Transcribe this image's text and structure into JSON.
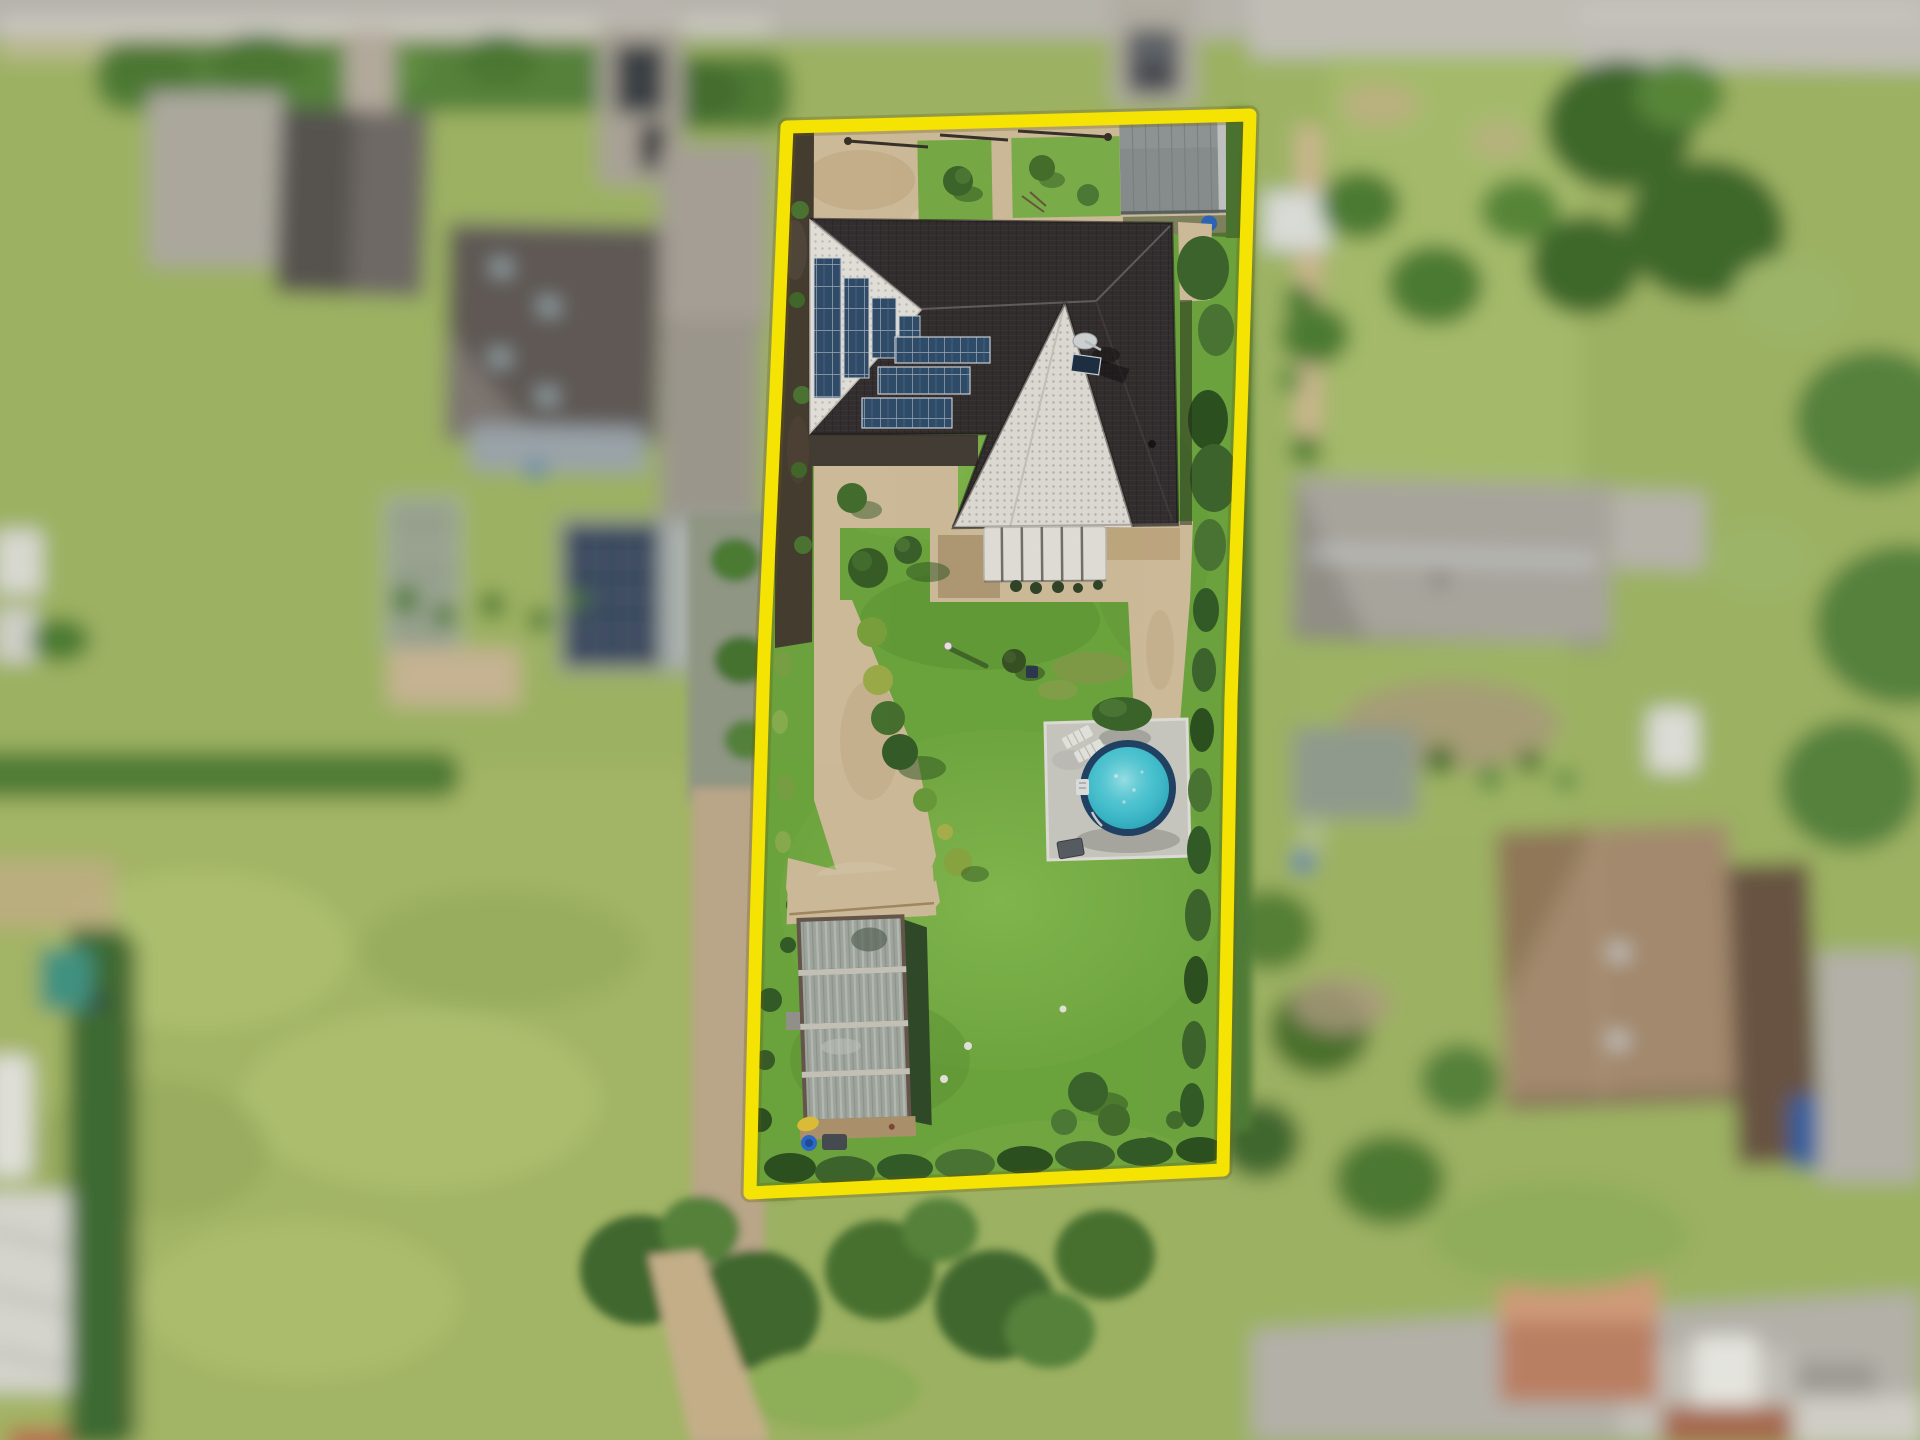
{
  "meta": {
    "image_type": "aerial-drone-photograph",
    "subject": "residential property highlighted with yellow plot boundary",
    "effect": "tilt-shift blur on surrounding neighborhood"
  },
  "colors": {
    "boundary_yellow": "#F5E303",
    "lawn_green": "#72AD41",
    "meadow_green": "#A2B465",
    "path_sand": "#D8C5A2",
    "roof_dark": "#363031",
    "gable_white": "#EDEBE4",
    "solar_panel": "#32506E",
    "pool_water": "#3FC6D6",
    "pool_rim": "#24466A",
    "pool_pad": "#D2D1C9",
    "hedge_green": "#41682F",
    "awning_white": "#ECEAE2",
    "shed_roof": "#8E9594",
    "greenhouse_glass": "#A8AFA6",
    "road_gray": "#B7B4AC",
    "background_grass": "#9CB162"
  },
  "lot": {
    "boundary_points": "787,127 1250,115 1242,385 1231,700 1223,1170 750,1193 756,930 764,655 776,390",
    "features": [
      "dark hip-roof house with rooftop solar arrays",
      "white gable face with stepped solar panels",
      "white slatted patio awning",
      "round above-ground pool with turquoise water on paved pad",
      "two white sun loungers",
      "glass greenhouse with four bays",
      "gray metal garden shed",
      "winding sand-stone garden path",
      "large lawn",
      "boundary hedge row",
      "garden lamp post",
      "blue rain barrels"
    ]
  },
  "surroundings": {
    "features": [
      "street with sidewalk at top",
      "neighboring houses with gray and brown roofs",
      "outbuilding with rooftop solar panel",
      "large green meadow at lower left",
      "dirt track along the plot",
      "terracotta-roof outbuilding at lower right",
      "parked cars",
      "trees, hedges and garden plots"
    ]
  }
}
